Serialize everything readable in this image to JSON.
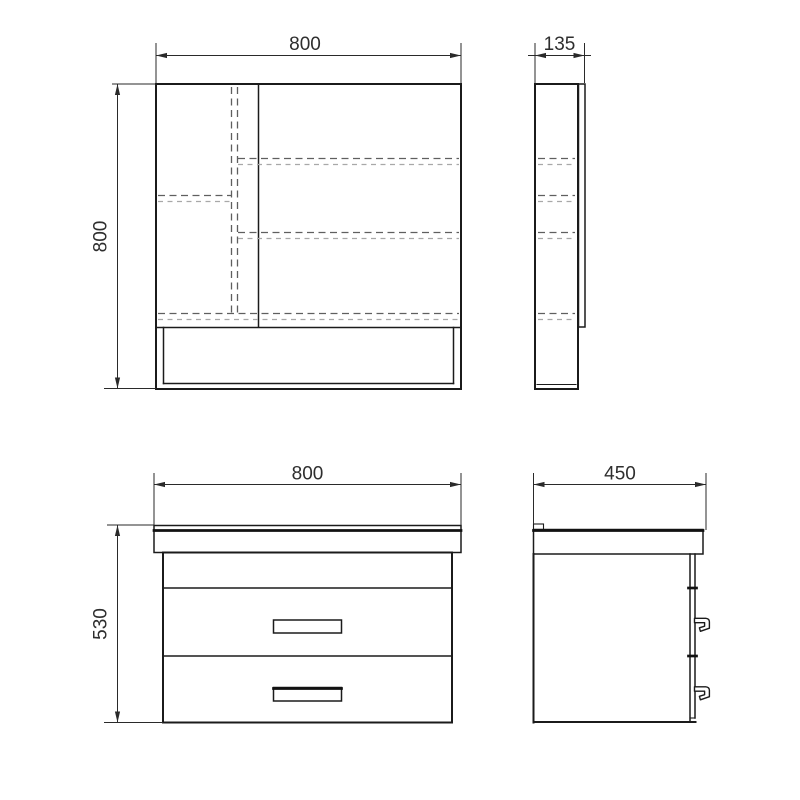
{
  "drawing": {
    "mirror_front": {
      "width_label": "800",
      "height_label": "800"
    },
    "mirror_side": {
      "width_label": "135"
    },
    "vanity_front": {
      "width_label": "800",
      "height_label": "530"
    },
    "vanity_side": {
      "width_label": "450"
    }
  },
  "colors": {
    "background": "#ffffff",
    "outline": "#1b1b1b",
    "dimension": "#2a2a2a",
    "dashed_dark": "#5f5f5f",
    "dashed_light": "#a8a8a8",
    "label_text": "#2e2e2e"
  }
}
